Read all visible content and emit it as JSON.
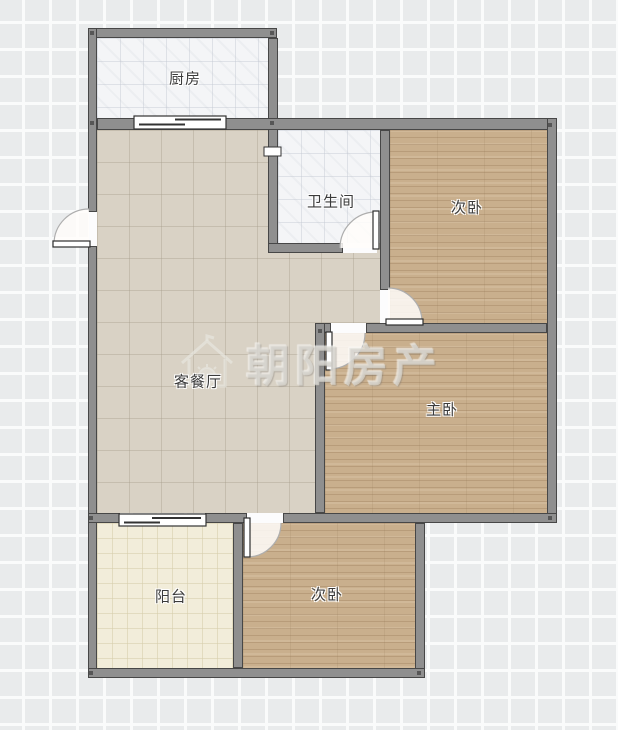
{
  "floorplan": {
    "watermark": {
      "brand": "朝阳房产",
      "icon": "house-sun-icon"
    },
    "rooms": [
      {
        "id": "kitchen",
        "label": "厨房",
        "floor": "tile-white"
      },
      {
        "id": "bathroom",
        "label": "卫生间",
        "floor": "tile-white"
      },
      {
        "id": "bedroom-top",
        "label": "次卧",
        "floor": "wood"
      },
      {
        "id": "living-dining",
        "label": "客餐厅",
        "floor": "tile-beige"
      },
      {
        "id": "master-bedroom",
        "label": "主卧",
        "floor": "wood"
      },
      {
        "id": "balcony",
        "label": "阳台",
        "floor": "tile-cream"
      },
      {
        "id": "bedroom-bottom",
        "label": "次卧",
        "floor": "wood"
      }
    ],
    "symbols": {
      "swing_door_icon": "quarter-arc-door",
      "sliding_door_icon": "offset-panel-door",
      "wall_joint_icon": "corner-dot"
    },
    "colors": {
      "wall": "#8f8f8f",
      "wall_outline": "#474747",
      "grid_background": "#e9ebec",
      "grid_line": "#fafbfb",
      "tile_white": "#f4f5f7",
      "tile_beige": "#d9d2c5",
      "tile_cream": "#f2edda",
      "wood": "#c9af8d",
      "label_text": "#3b3b3b",
      "watermark": "#e2e0da"
    }
  }
}
